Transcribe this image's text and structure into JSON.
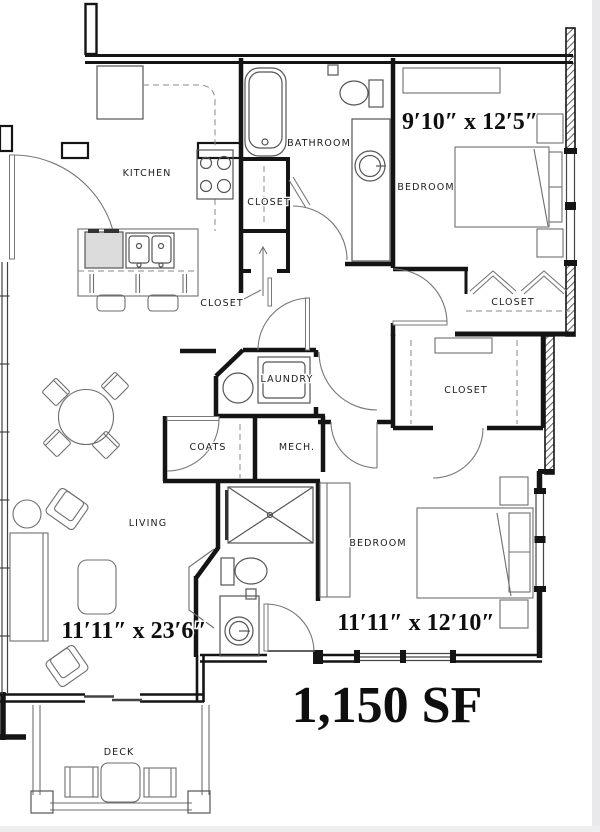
{
  "plan": {
    "area": "1,150 SF",
    "labels": {
      "kitchen": "KITCHEN",
      "bathroom": "BATHROOM",
      "closet_bath": "CLOSET",
      "closet_hall": "CLOSET",
      "bedroom1": "BEDROOM",
      "closet_bedroom1": "CLOSET",
      "closet_walkin": "CLOSET",
      "laundry": "LAUNDRY",
      "coats": "COATS",
      "mech": "MECH.",
      "living": "LIVING",
      "bedroom2": "BEDROOM",
      "deck": "DECK"
    },
    "dimensions": {
      "bedroom1": "9′10″ x 12′5″",
      "living": "11′11″ x 23′6″",
      "bedroom2": "11′11″ x 12′10″"
    }
  }
}
